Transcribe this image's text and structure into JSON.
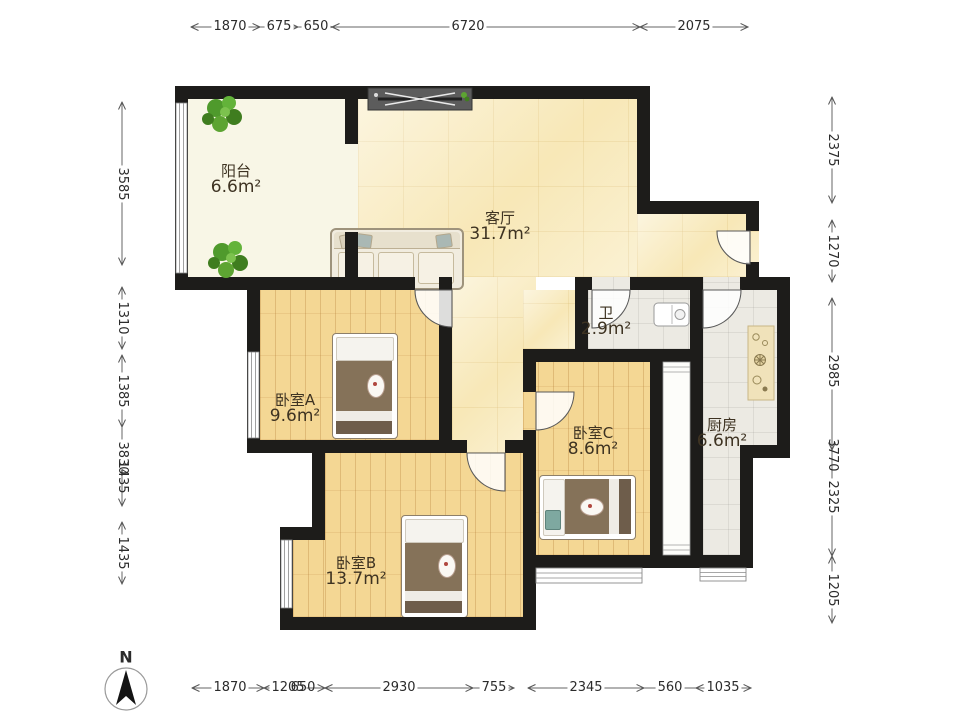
{
  "compass": {
    "label": "N"
  },
  "rooms": {
    "balcony": {
      "name": "阳台",
      "area": "6.6m²"
    },
    "living": {
      "name": "客厅",
      "area": "31.7m²"
    },
    "bathroom": {
      "name": "卫",
      "area": "2.9m²"
    },
    "kitchen": {
      "name": "厨房",
      "area": "6.6m²"
    },
    "bedroomA": {
      "name": "卧室A",
      "area": "9.6m²"
    },
    "bedroomB": {
      "name": "卧室B",
      "area": "13.7m²"
    },
    "bedroomC": {
      "name": "卧室C",
      "area": "8.6m²"
    }
  },
  "dims": {
    "top": [
      "1870",
      "675",
      "650",
      "6720",
      "2075"
    ],
    "bottom": [
      "1870",
      "1205",
      "650",
      "2930",
      "755",
      "2345",
      "560",
      "1035"
    ],
    "left": [
      "3585",
      "1310",
      "1385",
      "3830",
      "1435",
      "1435"
    ],
    "right": [
      "2375",
      "1270",
      "2985",
      "3770",
      "2325",
      "1205"
    ]
  },
  "colors": {
    "wall": "#1d1c1a",
    "marble_floor": "#f9edc5",
    "wood_floor": "#f4d794",
    "tile_floor": "#eceae3",
    "balcony_floor": "#f8f6e6",
    "counter": "#f0e2ba",
    "plant": "#4f9a2c",
    "dimension_text": "#2b2b2b"
  }
}
